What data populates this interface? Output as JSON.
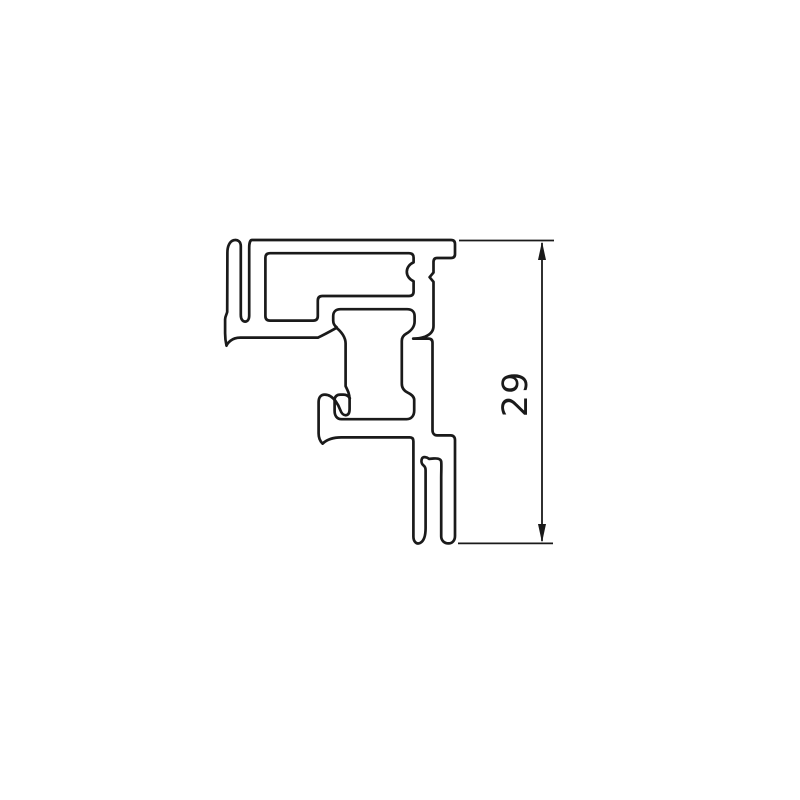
{
  "drawing": {
    "kind": "extrusion-profile-cross-section",
    "dimension": {
      "value": "29",
      "orientation": "vertical"
    },
    "colors": {
      "line": "#1a1a1a",
      "background": "#ffffff"
    }
  }
}
